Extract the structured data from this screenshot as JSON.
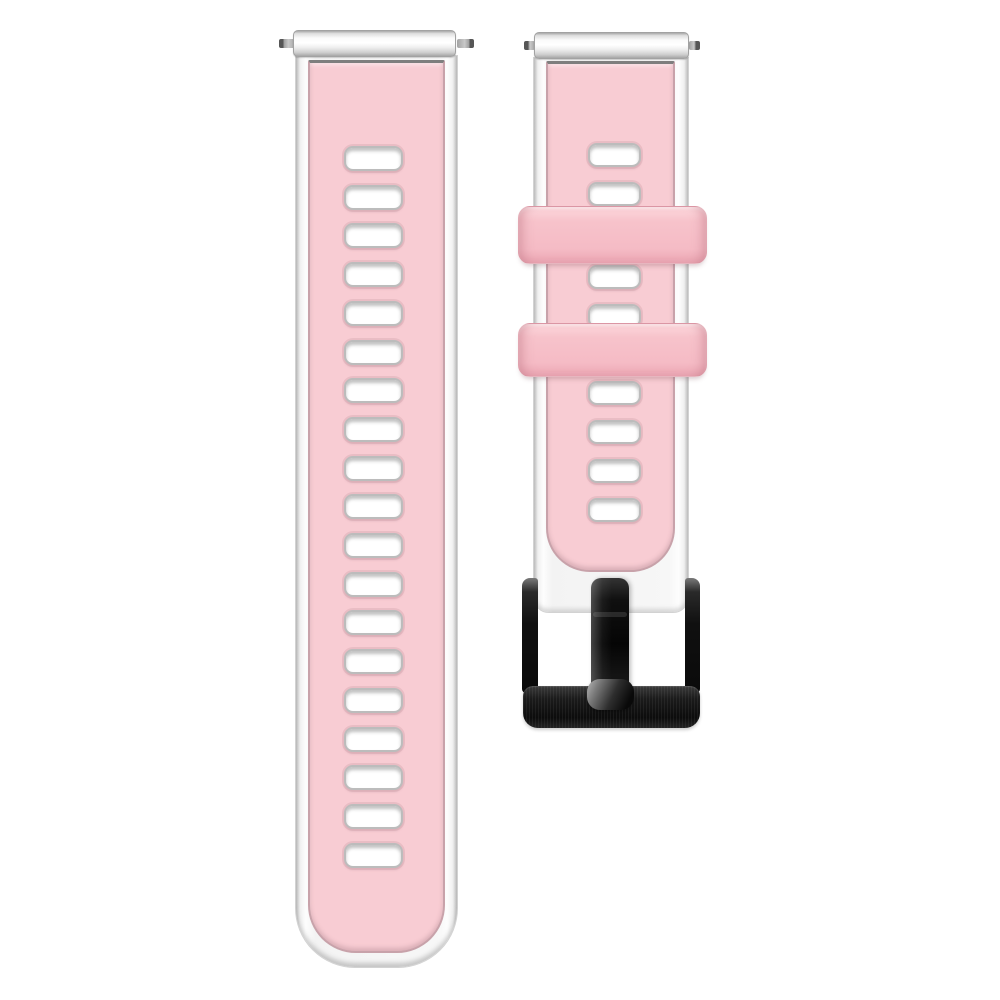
{
  "meta": {
    "type": "product-photo",
    "subject": "Two-piece quick-release silicone watch band: pink top layer bonded to a white base layer, rectangular vent holes, two pink keeper loops, black brushed-metal pin buckle",
    "background_color": "#ffffff"
  },
  "palette": {
    "strap_pink": "#f8ccd3",
    "loop_pink": "#f7c3cb",
    "white_base": "#f5f5f5",
    "edge_gray": "#c4c4c4",
    "top_seam_dark": "#7e7e7e",
    "hole_fill": "#ffffff",
    "hole_border": "#bcbcbc",
    "spring_bar_silver": "#e9e9e9",
    "pin_gray": "#9f9f9f",
    "buckle_black": "#0c0c0c",
    "buckle_highlight": "#7a7a7a",
    "tang_highlight": "#b9b9b9"
  },
  "left_strap": {
    "part": "tail-strap-half",
    "box": {
      "x": 295,
      "y": 30,
      "w": 163,
      "h": 940
    },
    "holes": {
      "count": 19,
      "x": 48,
      "first_y": 90,
      "spacing": 38.7,
      "w": 59,
      "h": 25
    }
  },
  "right_strap": {
    "part": "buckle-strap-half",
    "box": {
      "x": 533,
      "y": 32,
      "w": 156,
      "h": 700
    },
    "holes": {
      "x": 54,
      "w": 53,
      "h": 24,
      "ys": [
        85,
        124,
        207,
        246,
        323,
        362,
        401,
        440
      ]
    },
    "keeper_loops": [
      {
        "x": -15,
        "y": 174,
        "w": 189,
        "h": 58
      },
      {
        "x": -15,
        "y": 291,
        "w": 189,
        "h": 54
      }
    ],
    "buckle": {
      "style": "black brushed pin buckle",
      "parts": [
        "left-arm",
        "right-arm",
        "bottom-bar",
        "tang"
      ]
    }
  }
}
